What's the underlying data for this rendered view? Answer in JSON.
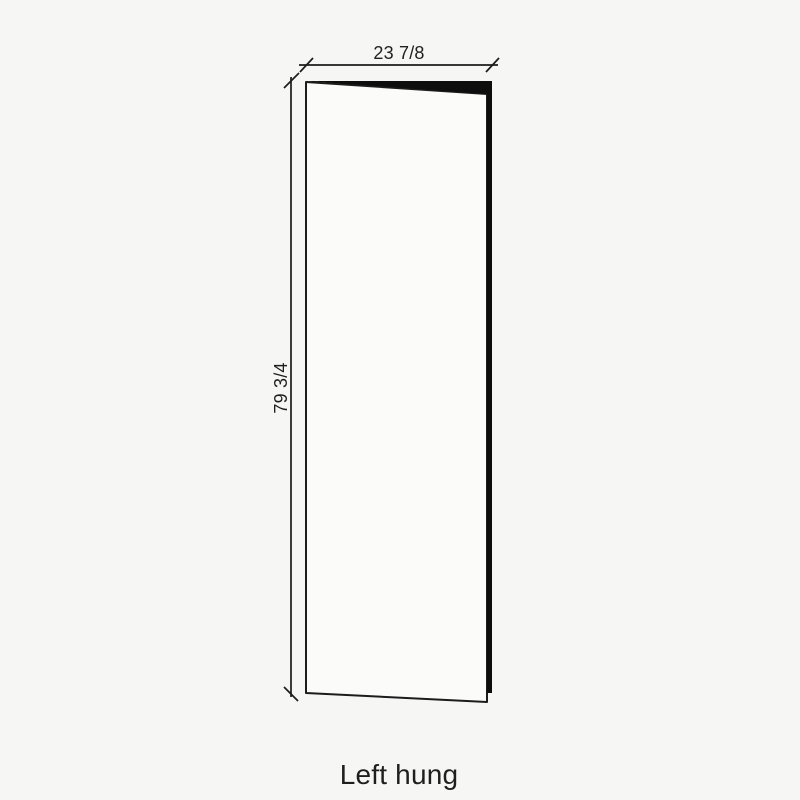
{
  "diagram": {
    "caption": "Left hung",
    "width_dimension": "23 7/8",
    "height_dimension": "79 3/4"
  },
  "icons": {
    "door_panel": "left-hung-door-panel"
  },
  "colors": {
    "background": "#f6f6f4",
    "line": "#1c1c1c",
    "text": "#1f1f1f",
    "door_face": "#fbfbfa",
    "door_edge": "#0d0d0d"
  }
}
